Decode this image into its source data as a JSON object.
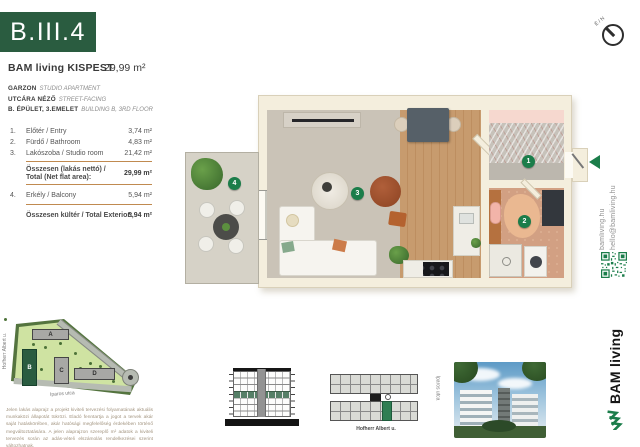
{
  "brand": {
    "green": "#2a5c40",
    "accent_green": "#1b7d4a"
  },
  "header": {
    "unit_code": "B.III.4",
    "project_name": "BAM living KISPEST",
    "total_area": "29,99 m²"
  },
  "unit_attributes": [
    {
      "hu": "GARZON",
      "en": "STUDIO APARTMENT"
    },
    {
      "hu": "UTCÁRA NÉZŐ",
      "en": "STREET-FACING"
    },
    {
      "hu": "B. ÉPÜLET, 3.EMELET",
      "en": "BUILDING B, 3RD FLOOR"
    }
  ],
  "area_table": {
    "rows": [
      {
        "no": "1.",
        "label": "Előtér / Entry",
        "value": "3,74 m²"
      },
      {
        "no": "2.",
        "label": "Fürdő / Bathroom",
        "value": "4,83 m²"
      },
      {
        "no": "3.",
        "label": "Lakószoba / Studio room",
        "value": "21,42 m²"
      }
    ],
    "net_total": {
      "label_hu": "Összesen (lakás nettó) /",
      "label_en": "Total (Net flat area):",
      "value": "29,99 m²"
    },
    "exterior_rows": [
      {
        "no": "4.",
        "label": "Erkély / Balcony",
        "value": "5,94 m²"
      }
    ],
    "exterior_total": {
      "label": "Összesen kültér / Total Exterior:",
      "value": "5,94 m²"
    }
  },
  "site_plan": {
    "buildings": [
      {
        "label": "A"
      },
      {
        "label": "B"
      },
      {
        "label": "C"
      },
      {
        "label": "D"
      }
    ],
    "highlighted_building": "B",
    "street_left": "Hofherr Albert u.",
    "street_bottom": "Iparos utca"
  },
  "floor_plan": {
    "markers": [
      {
        "num": "1"
      },
      {
        "num": "2"
      },
      {
        "num": "3"
      },
      {
        "num": "4"
      }
    ],
    "compass_label": "É / N"
  },
  "footer_diagrams": {
    "overview_street_bottom": "Hofherr Albert u.",
    "overview_street_right": "Iparos utca"
  },
  "contact": {
    "website": "bamliving.hu",
    "email": "hello@bamliving.hu",
    "logo_text": "BAM living"
  },
  "disclaimer": "Jelen lakás alaprajz a projekt kiviteli tervezési folyamatának aktuális munkaközi állapotát tükrözi. Eladó fenntartja a jogot a tervek akár saját hatáskörében, akár hatósági megfelelőség érdekében történő megváltoztatására. A jelen alaprajzon szereplő m² adatok a kiviteli tervezés során az adás-vételi elszámolás rendelkezései szerint változhatnak."
}
